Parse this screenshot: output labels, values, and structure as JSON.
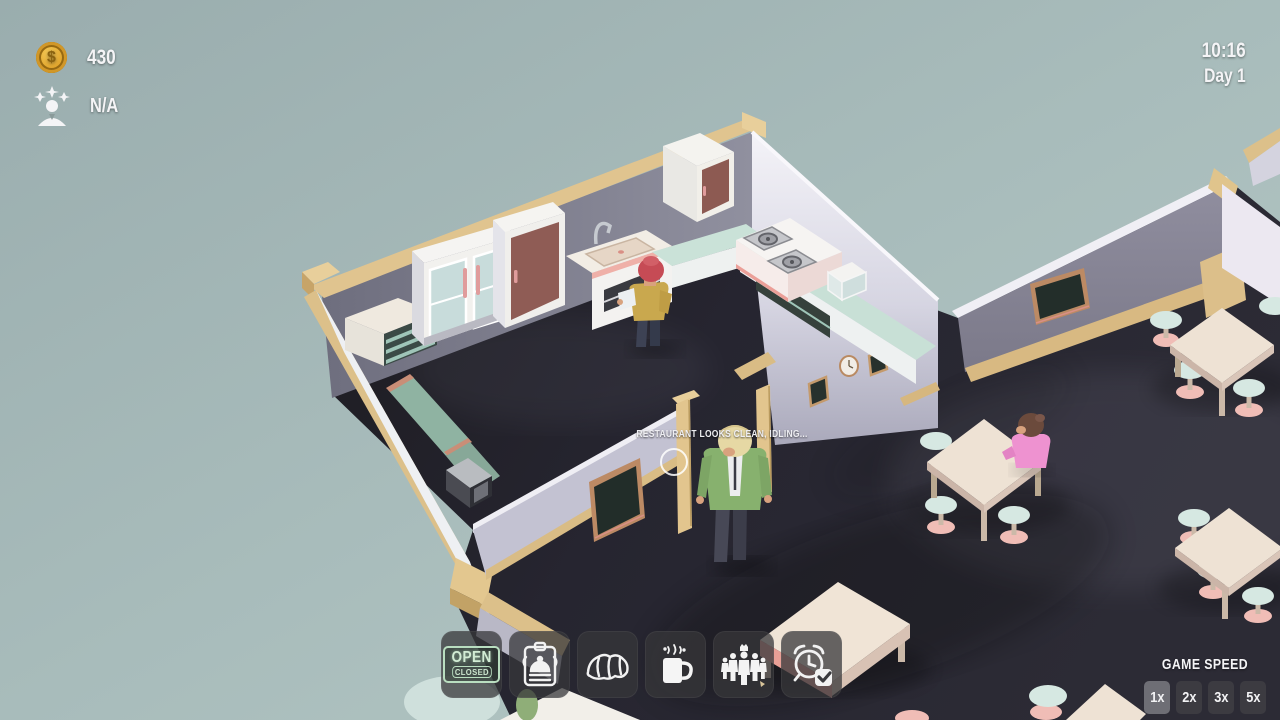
{
  "hud": {
    "money": "430",
    "money_symbol": "$",
    "rating": "N/A",
    "time": "10:16",
    "day": "Day 1"
  },
  "status_message": "RESTAURANT LOOKS CLEAN, IDLING...",
  "toolbar": {
    "open_closed": {
      "open_label": "OPEN",
      "closed_label": "CLOSED"
    },
    "buttons": [
      {
        "name": "open-closed-sign"
      },
      {
        "name": "service-bell"
      },
      {
        "name": "food-menu-croissant"
      },
      {
        "name": "drinks-menu-mug"
      },
      {
        "name": "staff"
      },
      {
        "name": "schedule-clock"
      }
    ]
  },
  "game_speed": {
    "label": "GAME SPEED",
    "options": [
      "1x",
      "2x",
      "3x",
      "5x"
    ],
    "selected": "1x"
  },
  "colors": {
    "background_teal": "#a7bbba",
    "floor_dark": "#26252b",
    "wall_lavender": "#c3c2d2",
    "wall_shadow": "#84828f",
    "wood_trim": "#e0c48f",
    "table_cream": "#eee2d4",
    "stool_mint": "#d6e8e2",
    "stool_pink": "#f0bdb6",
    "cabinet_redbrown": "#8d5a52",
    "counter_teal": "#c8e0d6",
    "coin_gold": "#dfa32b",
    "chef_hair_pink": "#c64b55",
    "chef_shirt_yellow": "#c9a84e",
    "waitress_jacket_green": "#87b16e",
    "customer_shirt_pink": "#ee92d0",
    "open_sign_mint": "#cde6cf"
  }
}
